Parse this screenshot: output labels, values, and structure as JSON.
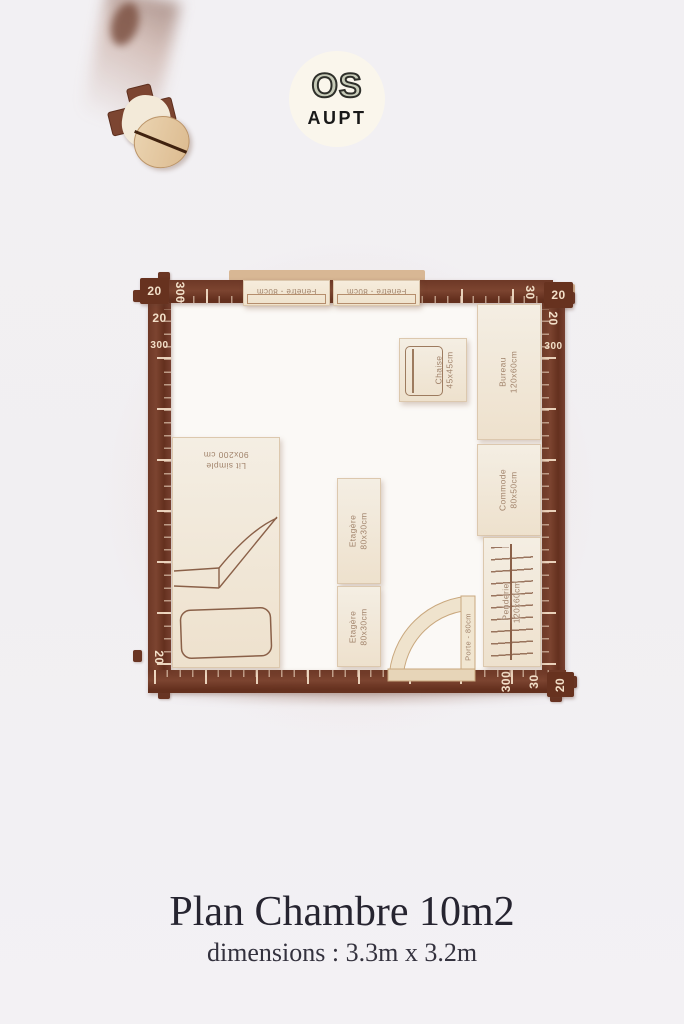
{
  "logo": {
    "top": "OS",
    "bottom": "AUPT"
  },
  "plan": {
    "rulers": {
      "top_left_corner": "20",
      "top_left_span": "300",
      "top_right_span": "30",
      "top_right_corner": "20",
      "left_top": "20",
      "left_span": "300",
      "left_bottom": "20",
      "right_top": "20",
      "right_span": "300",
      "bottom_right_span": "300",
      "bottom_right_minor": "30",
      "bottom_right_corner": "20"
    },
    "furniture": {
      "fenetre1": {
        "label": "Fenêtre - 80cm"
      },
      "fenetre2": {
        "label": "Fenêtre - 80cm"
      },
      "bureau": {
        "line1": "Bureau",
        "line2": "120x60cm"
      },
      "chaise": {
        "line1": "Chaise",
        "line2": "45x45cm"
      },
      "commode": {
        "line1": "Commode",
        "line2": "80x50cm"
      },
      "penderie": {
        "line1": "Penderie",
        "line2": "120x60cm"
      },
      "lit": {
        "line1": "Lit simple",
        "line2": "90x200 cm"
      },
      "etagere1": {
        "line1": "Etagère",
        "line2": "80x30cm"
      },
      "etagere2": {
        "line1": "Etagère",
        "line2": "80x30cm"
      },
      "porte": {
        "label": "Porte - 80cm"
      }
    }
  },
  "caption": {
    "title": "Plan Chambre 10m2",
    "subtitle": "dimensions : 3.3m x 3.2m"
  },
  "colors": {
    "wall": "#6e3a27",
    "wood": "#f2e9dc",
    "engraving": "#a1836b",
    "badge_bg": "#faf6ec"
  }
}
